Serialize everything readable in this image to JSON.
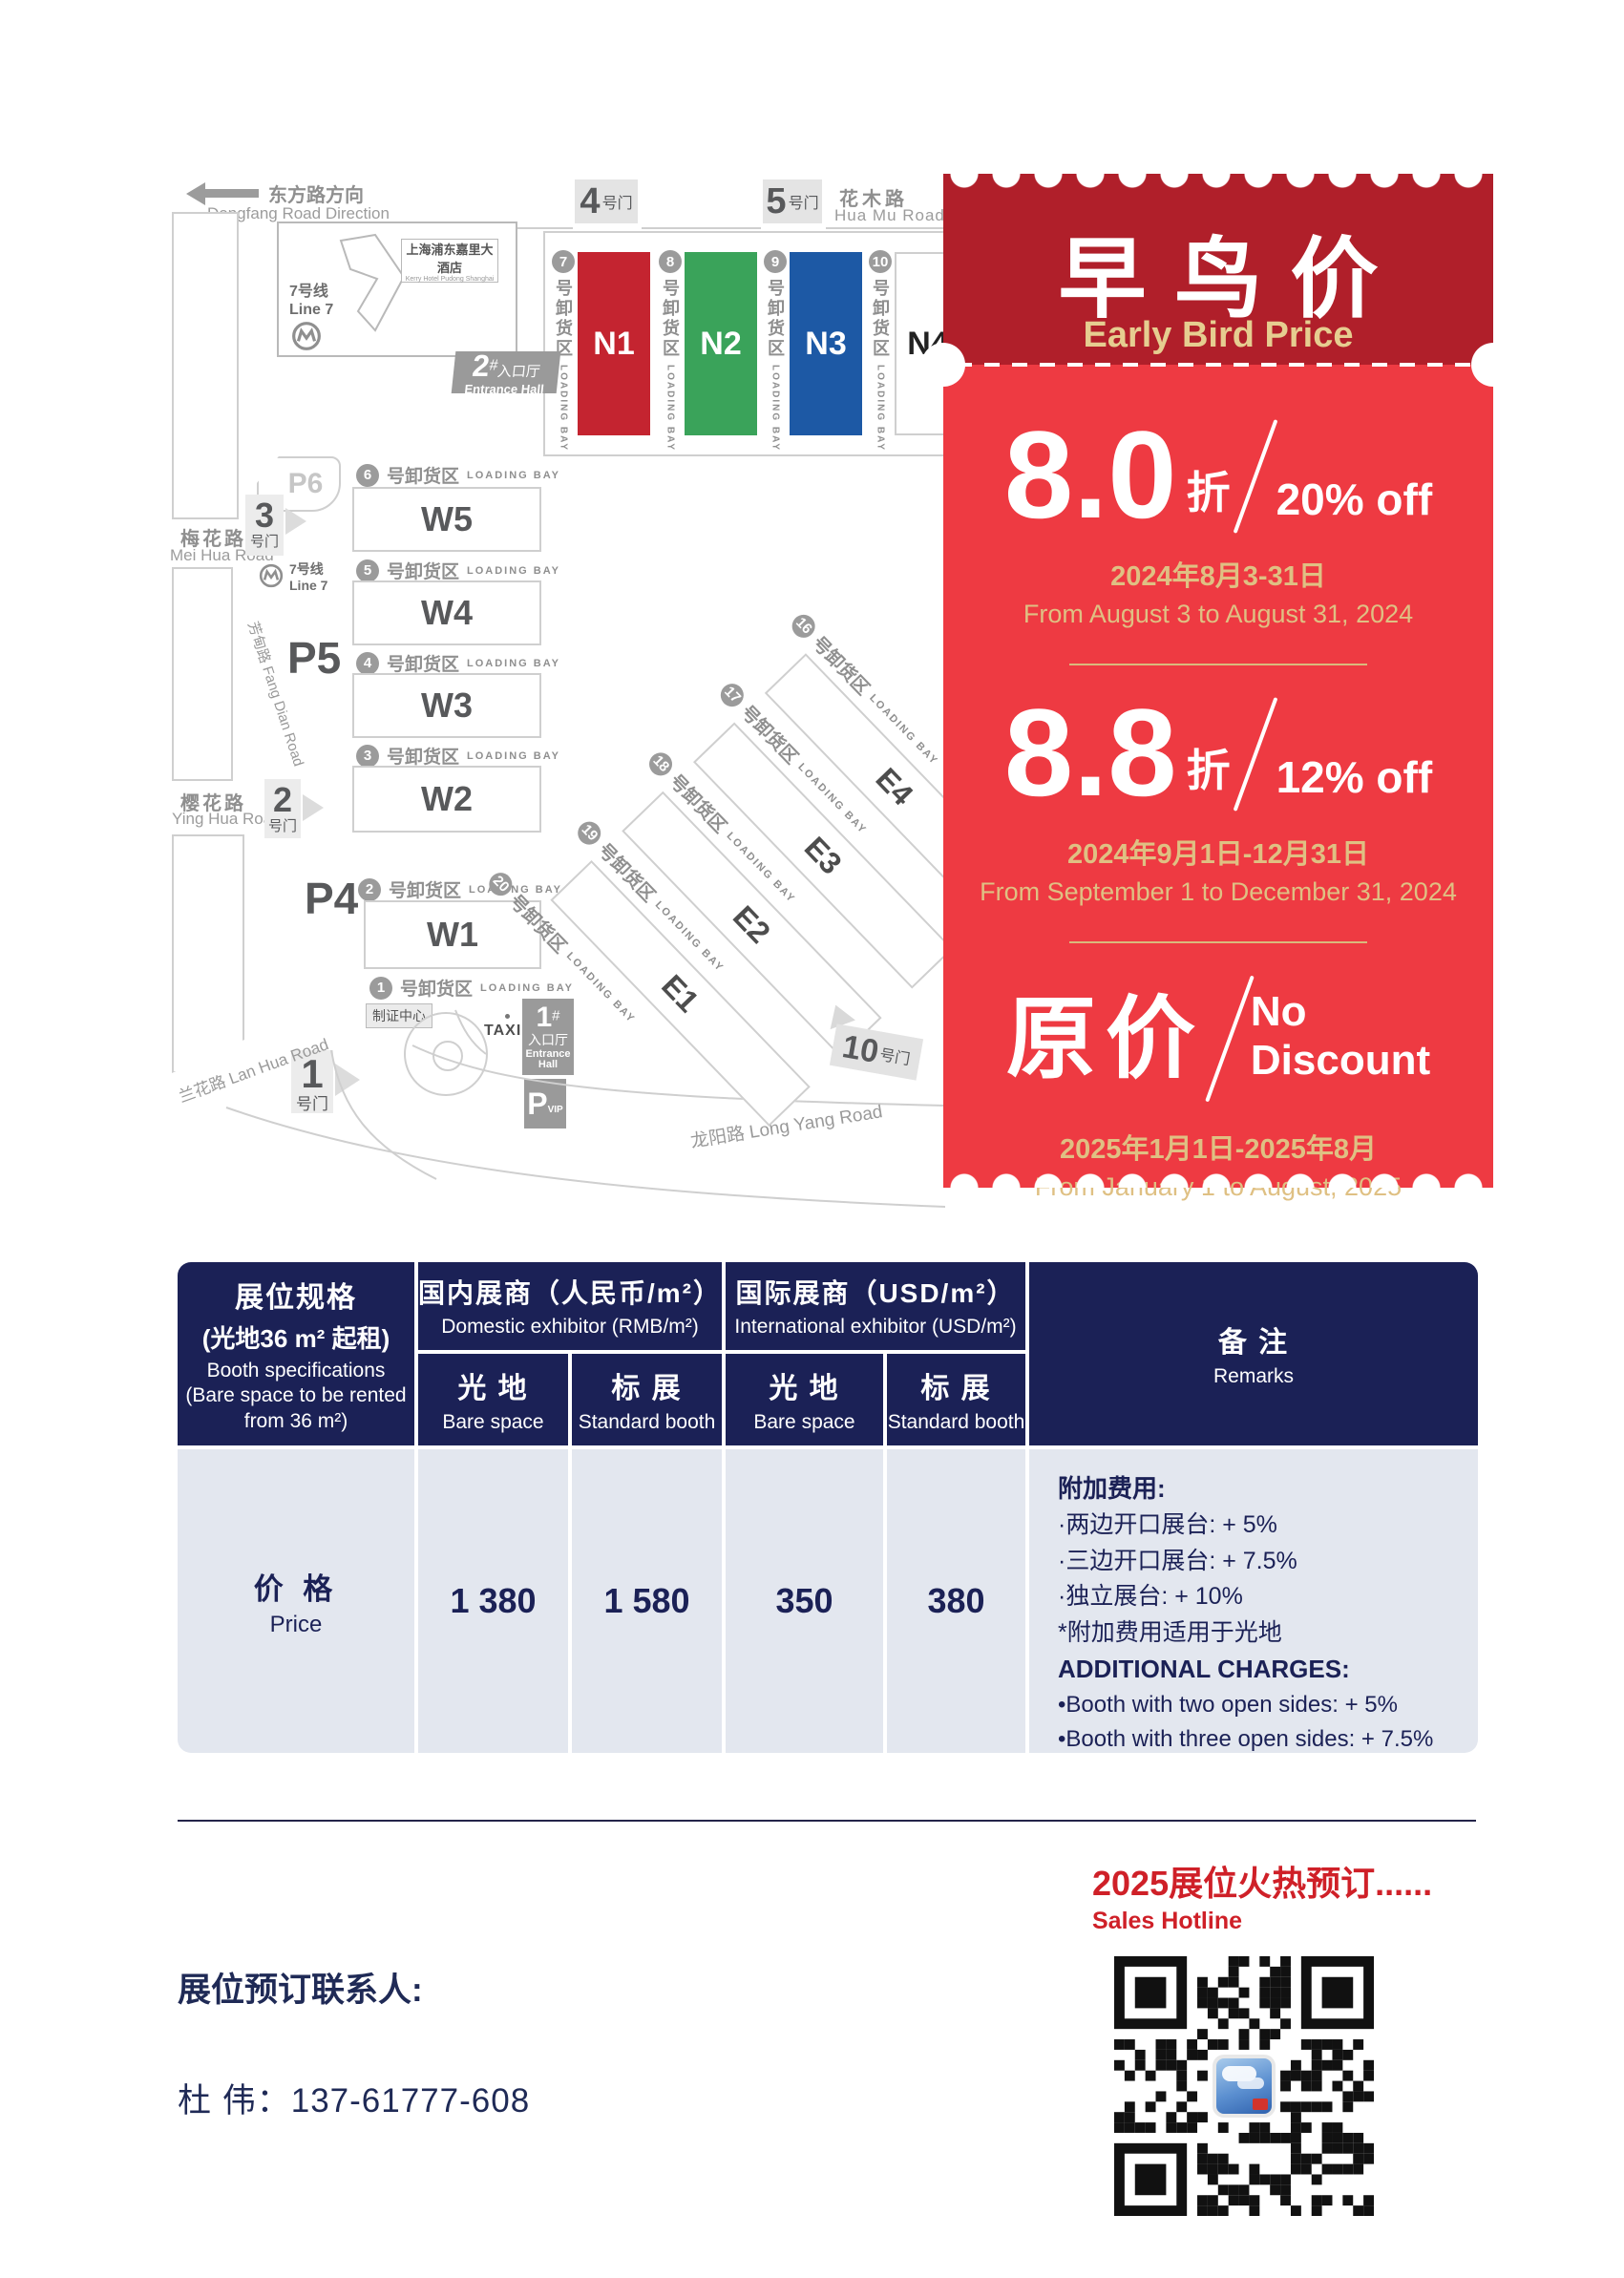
{
  "map": {
    "direction_zh": "东方路方向",
    "direction_en": "Dongfang Road Direction",
    "roads": {
      "huamu_zh": "花木路",
      "huamu_en": "Hua Mu Road",
      "meihua_zh": "梅花路",
      "meihua_en": "Mei Hua Road",
      "yinghua_zh": "樱花路",
      "yinghua_en": "Ying Hua Road",
      "fangdian": "芳甸路  Fang Dian Road",
      "lanhua": "兰花路  Lan Hua Road",
      "longyang": "龙阳路  Long Yang Road"
    },
    "gate_suffix": "号门",
    "gate4_num": "4",
    "gate5_num": "5",
    "gate3_num": "3",
    "gate2_num": "2",
    "gate1_num": "1",
    "gate10_num": "10",
    "hotel_zh": "上海浦东嘉里大酒店",
    "hotel_en": "Kerry Hotel Pudong Shanghai",
    "metro_zh": "7号线",
    "metro_en": "Line 7",
    "entrance2_num": "2",
    "entrance1_num": "1",
    "entrance_hash": "#",
    "entrance_zh": "入口厅",
    "entrance_en": "Entrance Hall",
    "badge_center": "制证中心",
    "taxi": "TAXI",
    "p_letter": "P",
    "vip": "VIP",
    "p6": "P6",
    "p5": "P5",
    "p4": "P4",
    "bay_suffix": "号卸货区",
    "loading_bay": "LOADING BAY",
    "n_halls": [
      {
        "bay": "7",
        "label": "N1",
        "color": "#c42430"
      },
      {
        "bay": "8",
        "label": "N2",
        "color": "#3aa35a"
      },
      {
        "bay": "9",
        "label": "N3",
        "color": "#1d59a5"
      },
      {
        "bay": "10",
        "label": "N4",
        "color": "#ffffff"
      }
    ],
    "w_halls": [
      {
        "bay": "6",
        "label": "W5"
      },
      {
        "bay": "5",
        "label": "W4"
      },
      {
        "bay": "4",
        "label": "W3"
      },
      {
        "bay": "3",
        "label": "W2"
      },
      {
        "bay": "2",
        "label": "W1"
      }
    ],
    "w_last_bay": "1",
    "e_halls": [
      {
        "bay": "16",
        "label": "E4"
      },
      {
        "bay": "17",
        "label": "E3"
      },
      {
        "bay": "18",
        "label": "E2"
      },
      {
        "bay": "19",
        "label": "E1"
      }
    ],
    "e_last_bay": "20"
  },
  "ticket": {
    "header_bg": "#b01f2a",
    "body_bg": "#ee3a42",
    "gold": "#dfc083",
    "title_zh": "早鸟价",
    "title_en": "Early Bird Price",
    "tiers": [
      {
        "value": "8.0",
        "unit": "折",
        "discount": "20% off",
        "date_zh": "2024年8月3-31日",
        "date_en": "From August 3 to August 31, 2024"
      },
      {
        "value": "8.8",
        "unit": "折",
        "discount": "12% off",
        "date_zh": "2024年9月1日-12月31日",
        "date_en": "From September 1 to December 31, 2024"
      },
      {
        "value": "原价",
        "discount_line1": "No",
        "discount_line2": "Discount",
        "date_zh": "2025年1月1日-2025年8月",
        "date_en": "From January 1 to August, 2025"
      }
    ]
  },
  "table": {
    "header_bg": "#1b2156",
    "body_bg": "#e3e7ef",
    "spec_zh1": "展位规格",
    "spec_zh2": "(光地36 m² 起租)",
    "spec_en1": "Booth specifications",
    "spec_en2": "(Bare space to be rented",
    "spec_en3": "from 36 m²)",
    "domestic_zh": "国内展商（人民币/m²）",
    "domestic_en": "Domestic exhibitor (RMB/m²)",
    "intl_zh": "国际展商（USD/m²）",
    "intl_en": "International exhibitor (USD/m²)",
    "bare_zh": "光 地",
    "bare_en": "Bare space",
    "std_zh": "标 展",
    "std_en": "Standard booth",
    "remarks_zh": "备 注",
    "remarks_en": "Remarks",
    "price_zh": "价 格",
    "price_en": "Price",
    "values": [
      "1 380",
      "1 580",
      "350",
      "380"
    ],
    "remarks_cn": [
      "附加费用:",
      "·两边开口展台: + 5%",
      "·三边开口展台: + 7.5%",
      "·独立展台: + 10%",
      "*附加费用适用于光地"
    ],
    "remarks_en_lines": [
      "ADDITIONAL CHARGES:",
      "•Booth with two open sides: + 5%",
      "•Booth with three open sides: + 7.5%",
      "•Independent booth: + 10%",
      "*Additional charges apply to bare space"
    ]
  },
  "footer": {
    "accent": "#cf2028",
    "hotline_zh": "2025展位火热预订......",
    "hotline_en": "Sales Hotline",
    "contact_label": "展位预订联系人:",
    "contact_line": "杜  伟：137-61777-608"
  }
}
